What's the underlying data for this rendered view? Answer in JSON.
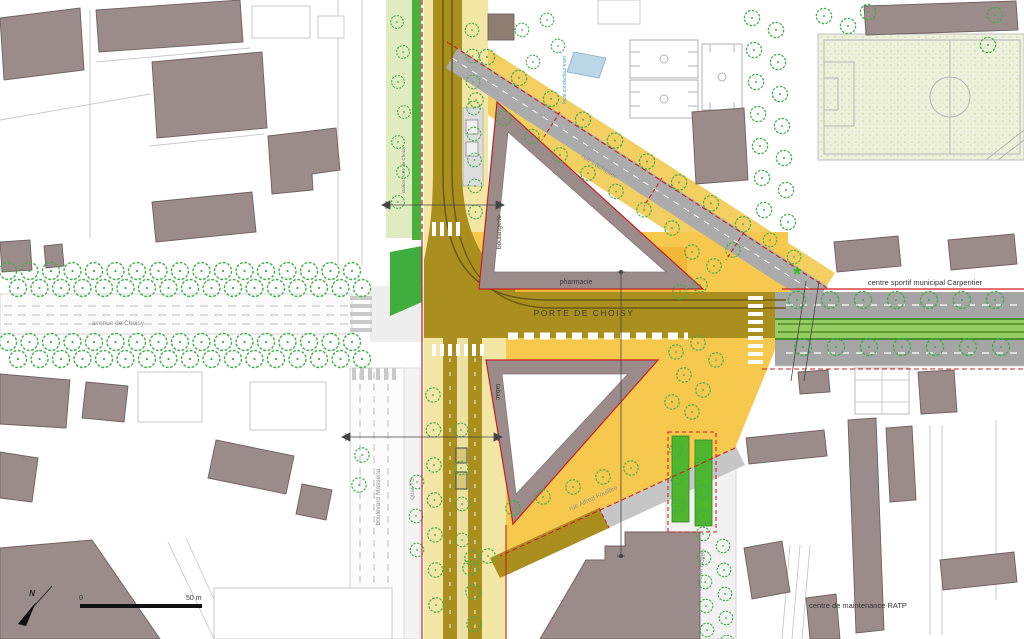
{
  "map": {
    "labels": {
      "porte_de_choisy": "PORTE DE CHOISY",
      "pharmacie": "pharmacie",
      "boulangerie": "boulangerie",
      "tabac": "tabac",
      "rue_lachelier": "rue Lachelier",
      "centre_sportif": "centre sportif municipal Carpentier",
      "centre_maintenance": "centre de maintenance RATP",
      "avenue_de_choisy": "avenue de Choisy",
      "boulevard_massena": "boulevard Masséna",
      "quai_t3": "quai T3",
      "rue_alfred_fouillee": "rue Alfred Fouillée",
      "avenue_leon_bollee": "avenue Léon Bollée",
      "local_conducteur_tram": "local conducteur tram",
      "station_porte_de_choisy": "station Porte de Choisy",
      "north": "N",
      "asterisk": "*"
    },
    "scale_bar": {
      "start": "0",
      "end": "50 m"
    },
    "colors": {
      "building": "#9c8b8b",
      "tree": "#3fae49",
      "road_project_olive": "#aa8f1f",
      "plaza_orange": "#f6c84e",
      "platform_orange": "#f2b737",
      "sidewalk_yellow": "#f1e6a3",
      "lawn_green": "#4cb13c",
      "tram_median_green": "#96cd62",
      "boundary_red": "#cf1f1f",
      "road_context_gray": "#a5a5a5",
      "sports_field": "#edf0da",
      "tram_facility_blue": "#b9d7e6"
    }
  }
}
